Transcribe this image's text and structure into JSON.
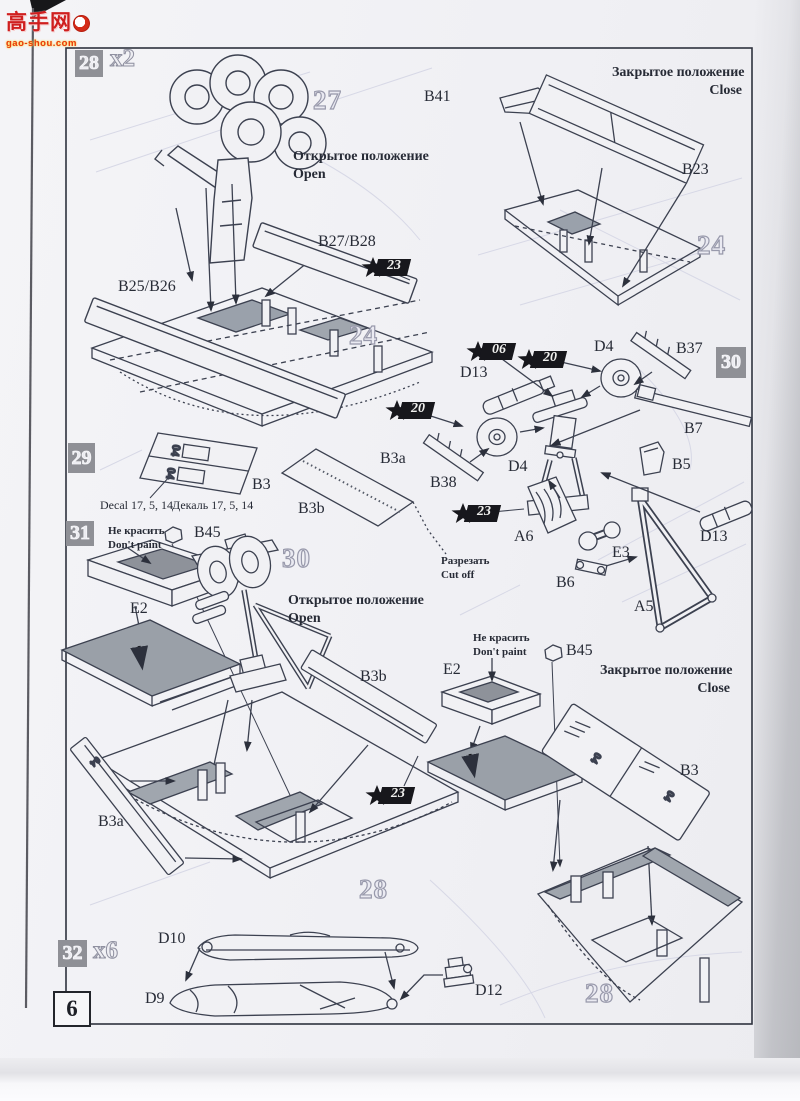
{
  "watermark": {
    "title": "高手网",
    "site": "gao-shou.com"
  },
  "page_number": "6",
  "steps": {
    "s28": {
      "num": "28",
      "qty": "x2"
    },
    "s29": {
      "num": "29"
    },
    "s30": {
      "num": "30"
    },
    "s31": {
      "num": "31"
    },
    "s32": {
      "num": "32",
      "qty": "x6"
    }
  },
  "refs": {
    "n27": "27",
    "n24": "24",
    "n30": "30",
    "n28": "28"
  },
  "callouts": {
    "c23": "23",
    "c20": "20",
    "c06": "06"
  },
  "parts": {
    "B41": "B41",
    "B23": "B23",
    "B27_28": "B27/B28",
    "B25_26": "B25/B26",
    "D4": "D4",
    "B37": "B37",
    "D13": "D13",
    "B38": "B38",
    "B7": "B7",
    "B5": "B5",
    "A6": "A6",
    "E3": "E3",
    "B6": "B6",
    "A5": "A5",
    "B45": "B45",
    "E2": "E2",
    "B3": "B3",
    "B3a": "B3a",
    "B3b": "B3b",
    "D10": "D10",
    "D9": "D9",
    "D12": "D12"
  },
  "notes": {
    "open_ru": "Открытое положение",
    "open_en": "Open",
    "close_ru": "Закрытое положение",
    "close_en": "Close",
    "dont_paint_ru": "Не красить",
    "dont_paint_en": "Don't paint",
    "cut_ru": "Разрезать",
    "cut_en": "Cut off",
    "decal_en": "Decal  17, 5, 14",
    "decal_ru": "Декаль 17, 5, 14",
    "decal_mark": "04"
  }
}
